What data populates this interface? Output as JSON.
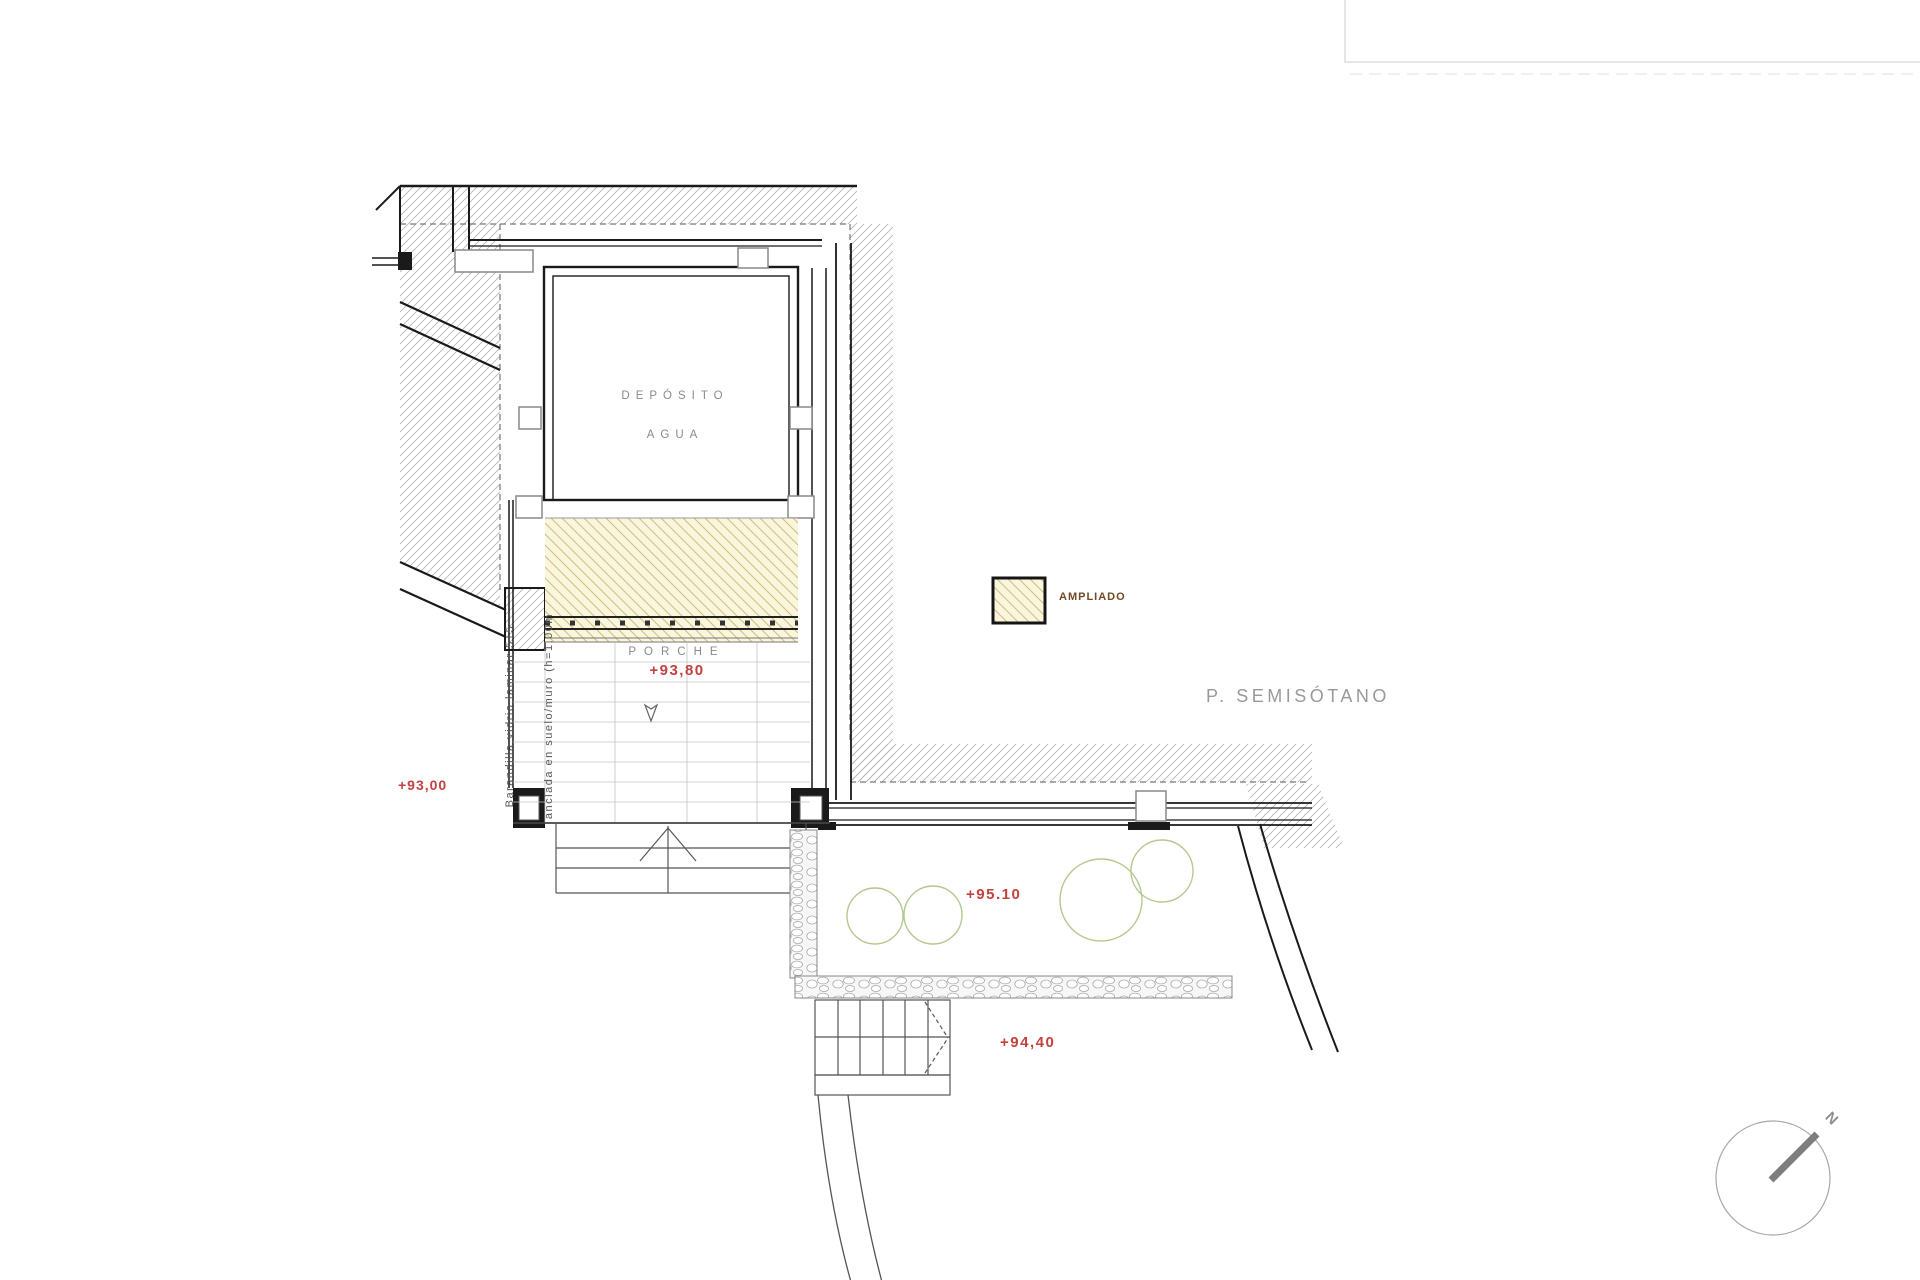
{
  "labels": {
    "room": {
      "line1": "DEPÓSITO",
      "line2": "AGUA"
    },
    "porch": {
      "name": "PORCHE",
      "level": "+93,80"
    },
    "levels": {
      "left": "+93,00",
      "terrace": "+95.10",
      "lower_terrace": "+94,40"
    },
    "legend": {
      "ampliado": "AMPLIADO"
    },
    "floor_title": "P. SEMISÓTANO",
    "railing_note": {
      "line1": "Barandilla vidrio laminar 5+5",
      "line2": "anclada en suelo/muro (h=1.00m"
    },
    "compass": {
      "north": "N"
    }
  },
  "colors": {
    "level_red": "#c2423d",
    "ampliado_text": "#6f4a22",
    "plan_gray_text": "#8a8a8a",
    "wall_black": "#1a1a1a",
    "hatch_gray_line": "#b3b3b3",
    "ampliado_fill": "#faf5dd",
    "ampliado_hatch_line": "#cdbf7f",
    "tree_green": "#b5c98f"
  }
}
